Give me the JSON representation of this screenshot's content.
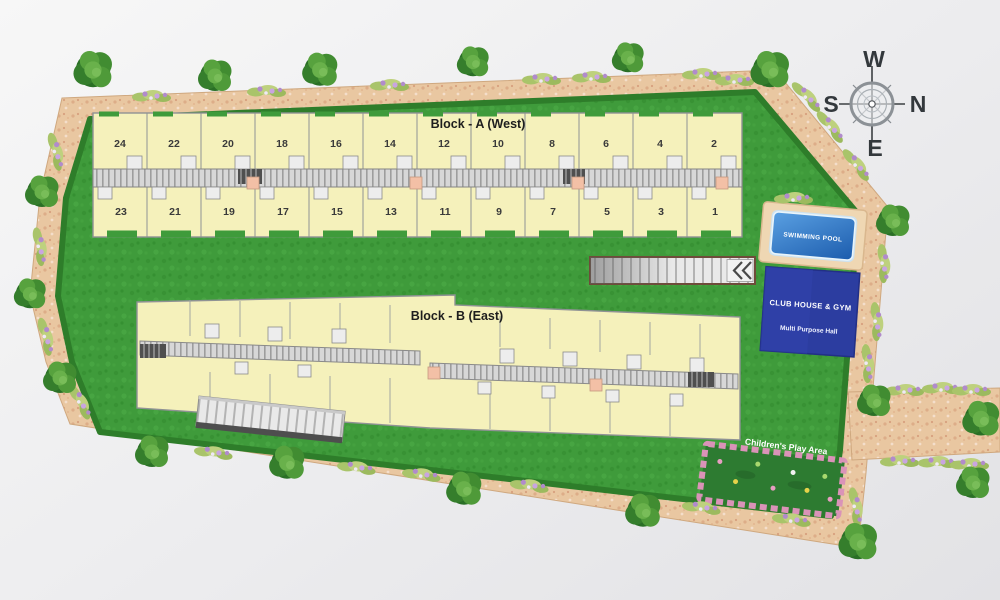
{
  "plan": {
    "block_a": {
      "label": "Block - A (West)",
      "top_units": [
        "24",
        "22",
        "20",
        "18",
        "16",
        "14",
        "12",
        "10",
        "8",
        "6",
        "4",
        "2"
      ],
      "bottom_units": [
        "23",
        "21",
        "19",
        "17",
        "15",
        "13",
        "11",
        "9",
        "7",
        "5",
        "3",
        "1"
      ]
    },
    "block_b": {
      "label": "Block - B (East)"
    },
    "amenities": {
      "swimming_pool": "SWIMMING POOL",
      "club_house": "CLUB HOUSE & GYM",
      "club_house_sub": "Multi Purpose Hall",
      "play_area": "Children's Play Area"
    },
    "compass": {
      "top": "W",
      "left": "S",
      "right": "N",
      "bottom": "E"
    },
    "colors": {
      "lawn_green": "#3f9b3b",
      "pathway_tan": "#e9c7a1",
      "building_cream": "#f5f1bb",
      "pool_blue": "#2e72c8",
      "club_blue": "#2c3da0",
      "play_border_pink": "#da93b8",
      "tree_green": "#418c31"
    }
  }
}
